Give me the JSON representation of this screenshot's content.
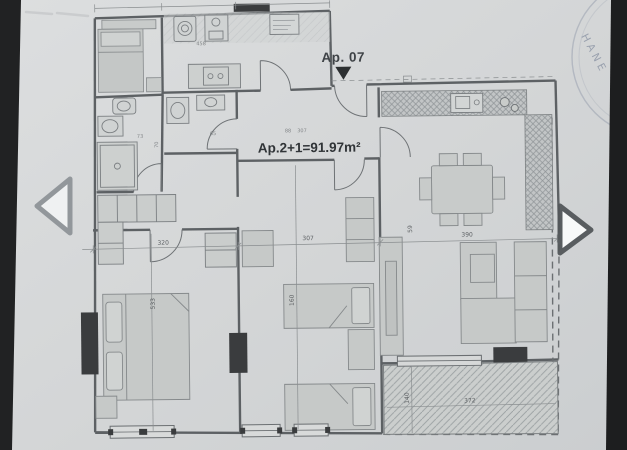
{
  "image_viewer": {
    "icons": {
      "prev": "chevron-left-icon",
      "next": "chevron-right-icon"
    }
  },
  "floor_plan": {
    "apartment_label": "Ap. 07",
    "area_label": "Ap.2+1=91.97m²",
    "stamp_text": "HANE",
    "entrance_marker": "triangle-down",
    "dimensions": {
      "room_left_width": "320",
      "room_middle_width": "307",
      "room_right_width": "390",
      "room_left_depth": "533",
      "bed_length": "160",
      "wall_offset": "59",
      "balcony_width": "372",
      "balcony_depth": "140",
      "bath_a": "73",
      "bath_b": "70",
      "wc_width": "65",
      "closet_width": "458",
      "hall_a": "88",
      "hall_b": "307"
    }
  },
  "colors": {
    "letterbox": "#202122",
    "paper": "#d5d7d8",
    "plan_line": "#5d6164",
    "furniture_fill": "#c8cbca",
    "column_fill": "#3a3c3e",
    "stamp": "#8e97a6",
    "arrow_light": "#f2f4f4",
    "arrow_dark_border": "#53575a"
  }
}
